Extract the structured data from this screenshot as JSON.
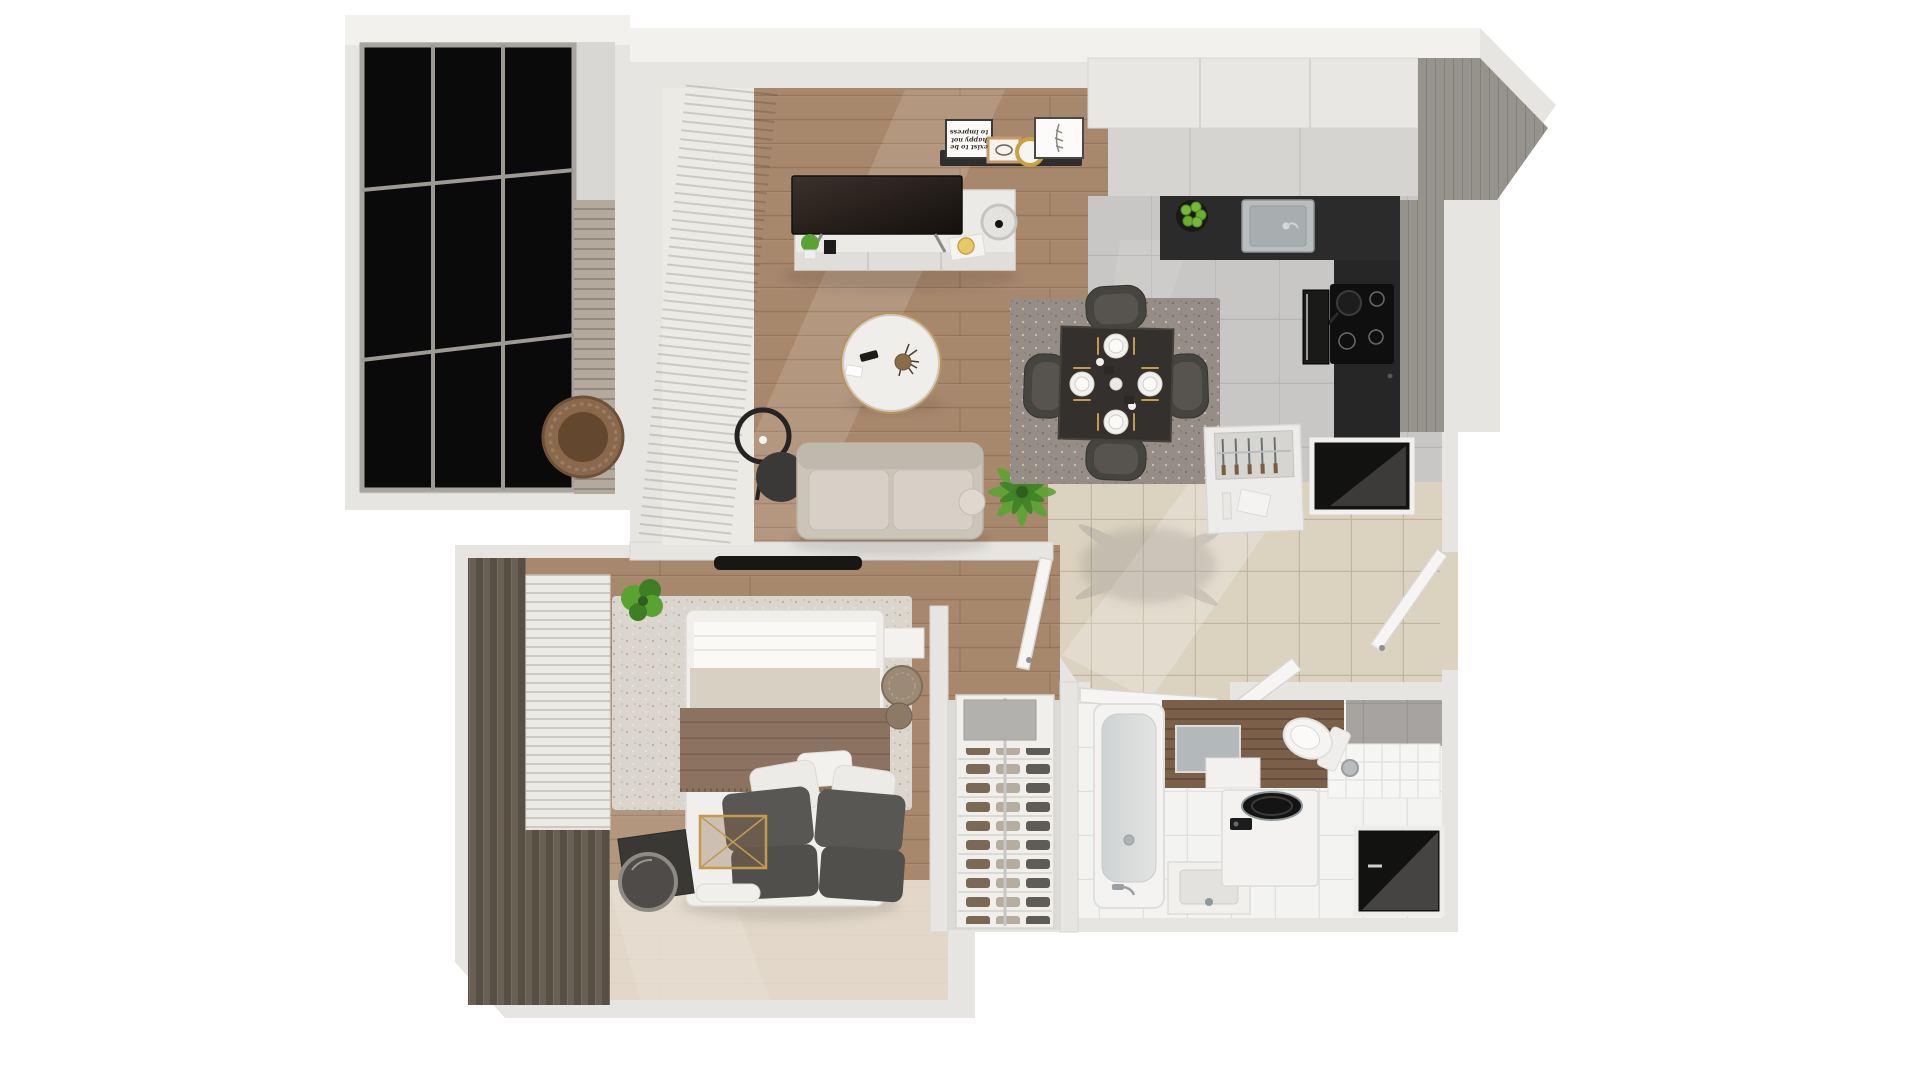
{
  "scene": {
    "kind": "apartment-floor-plan-3d-top-view",
    "description": "Top-down 3D render of a furnished one-bedroom apartment with balcony",
    "rooms": [
      {
        "name": "balcony",
        "furniture": [
          "glazed-dark-panels",
          "stone-clad-wall",
          "hanging-wicker-chair"
        ]
      },
      {
        "name": "living-room",
        "furniture": [
          "vertical-blinds",
          "tv-sideboard",
          "flat-tv",
          "picture-ledge",
          "quote-print",
          "sketch-frame",
          "gold-round-plate",
          "feather-frame",
          "drum-table-lamp",
          "ring-floor-lamp",
          "two-seat-sofa",
          "round-coffee-table",
          "palm-plant"
        ]
      },
      {
        "name": "kitchen",
        "furniture": [
          "white-cabinet-run",
          "dark-countertop",
          "inset-sink",
          "fruit-bowl-apples",
          "induction-hob",
          "frying-pan",
          "built-in-oven",
          "kettle",
          "concrete-feature-wall"
        ]
      },
      {
        "name": "dining-area",
        "furniture": [
          "speckled-rug",
          "square-dark-table",
          "four-upholstered-chairs",
          "plate-settings",
          "gold-cutlery"
        ]
      },
      {
        "name": "hallway",
        "furniture": [
          "beige-floor-tiles",
          "cutlery-sideboard",
          "dark-storage-niche",
          "entry-door",
          "shoe-rack",
          "palm-shadow"
        ]
      },
      {
        "name": "bedroom",
        "furniture": [
          "brown-drapes",
          "venetian-blinds",
          "double-bed",
          "brown-throw",
          "gray-pillows",
          "white-pillows",
          "speckled-rug",
          "wall-tv",
          "potted-plant",
          "dark-bedside-crate",
          "leaning-round-mirror",
          "gold-frame-side-table",
          "towel-stack",
          "wicker-basket"
        ]
      },
      {
        "name": "bathroom",
        "furniture": [
          "bathtub",
          "washbasin-cabinet",
          "top-load-washing-machine",
          "wall-hung-toilet",
          "tiled-counter",
          "wood-accent-wall",
          "wall-mirror",
          "dark-storage-niche",
          "open-double-doors"
        ]
      }
    ]
  },
  "decor": {
    "quote": "exist to be happy not to impress"
  },
  "colors": {
    "bg": "#ffffff",
    "wall": "#e7e5e2",
    "wall-top": "#f2f1ee",
    "wall-edge": "#d7d5d1",
    "wood": "#a8886d",
    "tile-kitchen": "#c8c7c5",
    "tile-hall": "#dcd2c0",
    "tile-bath": "#f3f3f1",
    "accent-wood": "#7b5f49",
    "counter-dark": "#2b2b2b",
    "cabinet": "#e8e7e4",
    "cabinet-face": "#d6d4d0",
    "concrete": "#96938d",
    "glass": "#0a0a0a",
    "stone": "#b3aa9d",
    "sofa": "#cbc4b9",
    "rug-dining": "#968e86",
    "rug-bedroom": "#dad5cd",
    "bed-white": "#f1efeb",
    "throw-brown": "#8c7260",
    "pillow-dark": "#595753",
    "drape": "#6a5f53",
    "blind": "#eceae5",
    "plant": "#5aa332",
    "plant-dark": "#3f7f24",
    "gold": "#c39a4e",
    "chair-dark": "#46443f",
    "door-white": "#f6f5f3",
    "niche-black": "#121211",
    "mirror": "#b3b8ba",
    "chrome": "#9aa0a3",
    "shelf-white": "#f0efec",
    "wicker": "#8a684c"
  }
}
